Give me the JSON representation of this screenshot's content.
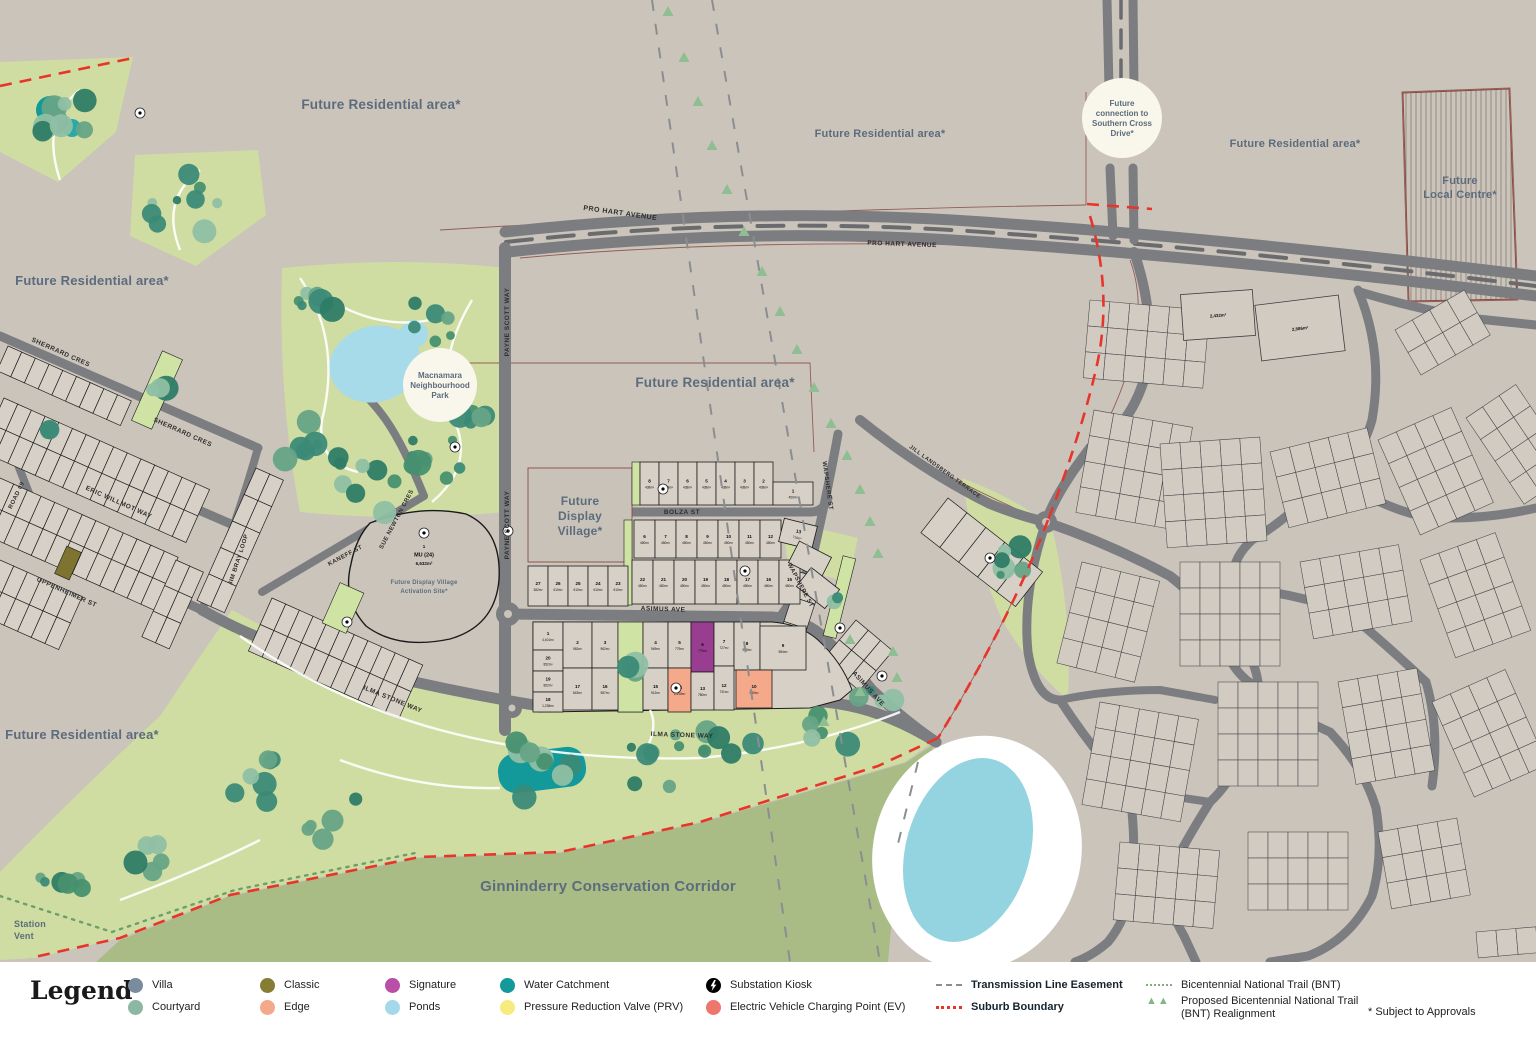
{
  "legend": {
    "title": "Legend",
    "items": [
      {
        "label": "Villa",
        "color": "#7b8b9e",
        "type": "dot"
      },
      {
        "label": "Courtyard",
        "color": "#8cb7a3",
        "type": "dot"
      },
      {
        "label": "Classic",
        "color": "#867d33",
        "type": "dot"
      },
      {
        "label": "Edge",
        "color": "#f4a98a",
        "type": "dot"
      },
      {
        "label": "Signature",
        "color": "#b94fa6",
        "type": "dot"
      },
      {
        "label": "Ponds",
        "color": "#a5d8e8",
        "type": "dot"
      },
      {
        "label": "Water Catchment",
        "color": "#14999b",
        "type": "dot"
      },
      {
        "label": "Pressure Reduction Valve (PRV)",
        "color": "#f7eb80",
        "type": "dot"
      },
      {
        "label": "Substation Kiosk",
        "color": "#000000",
        "type": "bolt"
      },
      {
        "label": "Electric Vehicle Charging Point (EV)",
        "color": "#ee766c",
        "type": "dot"
      },
      {
        "label": "Transmission Line Easement",
        "color": "#8b8e91",
        "type": "dash",
        "bold": true
      },
      {
        "label": "Suburb Boundary",
        "color": "#e8352b",
        "type": "reddash",
        "bold": true
      },
      {
        "label": "Bicentennial National Trail (BNT)",
        "color": "#7fae7f",
        "type": "dotted"
      },
      {
        "label": "Proposed Bicentennial National Trail (BNT) Realignment",
        "color": "#84b488",
        "type": "triangles"
      }
    ],
    "footnote": "* Subject to Approvals"
  },
  "map": {
    "colors": {
      "background": "#cbc4bb",
      "parkland": "#cfdda2",
      "conservation": "#a9bc85",
      "road": "#7c7d80",
      "lot_fill": "#d6d0c7",
      "suburb_lot_fill": "#d1cbc2",
      "pond": "#a7dbe9",
      "water_catchment": "#14999b",
      "signature_lot": "#993d90",
      "edge_lot": "#f4a98a",
      "classic_lot": "#7d7430",
      "boundary_red": "#e8352b",
      "easement_gray": "#8b8e91",
      "trail_green": "#6d9e6d"
    },
    "area_labels": [
      {
        "text": "Future Residential area*",
        "x": 381,
        "y": 109,
        "size": 13.5
      },
      {
        "text": "Future Residential area*",
        "x": 92,
        "y": 285,
        "size": 13
      },
      {
        "text": "Future Residential area*",
        "x": 880,
        "y": 137,
        "size": 11
      },
      {
        "text": "Future Residential area*",
        "x": 1295,
        "y": 147,
        "size": 11
      },
      {
        "text": "Future Residential area*",
        "x": 715,
        "y": 387,
        "size": 13.5
      },
      {
        "text": "Future Residential area*",
        "x": 82,
        "y": 739,
        "size": 13
      },
      {
        "text": "Ginninderry Conservation Corridor",
        "x": 608,
        "y": 891,
        "size": 15
      }
    ],
    "stacked_labels": [
      {
        "lines": [
          "Future",
          "Local Centre*"
        ],
        "x": 1460,
        "y": 184,
        "size": 11,
        "lh": 14
      },
      {
        "lines": [
          "Future",
          "Display",
          "Village*"
        ],
        "x": 580,
        "y": 505,
        "size": 12,
        "lh": 15
      },
      {
        "lines": [
          "Station",
          "Vent"
        ],
        "x": 14,
        "y": 927,
        "size": 9,
        "lh": 12,
        "color": "#3e6b51"
      }
    ],
    "callouts": [
      {
        "lines": [
          "Future",
          "connection to",
          "Southern Cross",
          "Drive*"
        ],
        "x": 1122,
        "y": 118,
        "r": 40,
        "size": 8
      },
      {
        "lines": [
          "Macnamara",
          "Neighbourhood",
          "Park"
        ],
        "x": 440,
        "y": 385,
        "r": 37,
        "size": 8
      }
    ],
    "mu_site": {
      "lines": [
        "1",
        "MU (24)",
        "6,632m²"
      ],
      "sub": [
        "Future Display Village",
        "Activation Site*"
      ]
    },
    "streets": [
      {
        "t": "PRO HART AVENUE",
        "x": 620,
        "y": 215,
        "r": 8,
        "s": 7
      },
      {
        "t": "PRO HART AVENUE",
        "x": 902,
        "y": 246,
        "r": 2,
        "s": 6.5
      },
      {
        "t": "PAYNE SCOTT WAY",
        "x": 509,
        "y": 322,
        "r": -90,
        "s": 6.5
      },
      {
        "t": "PAYNE SCOTT WAY",
        "x": 509,
        "y": 525,
        "r": -90,
        "s": 6.5
      },
      {
        "t": "SHERRARD CRES",
        "x": 60,
        "y": 354,
        "r": 24,
        "s": 6.5
      },
      {
        "t": "SHERRARD CRES",
        "x": 182,
        "y": 434,
        "r": 24,
        "s": 6.5
      },
      {
        "t": "ERIC WILLMOT WAY",
        "x": 118,
        "y": 504,
        "r": 24,
        "s": 6.5
      },
      {
        "t": "OPPENHEIMER ST",
        "x": 66,
        "y": 594,
        "r": 24,
        "s": 6.5
      },
      {
        "t": "ROAD 09",
        "x": 18,
        "y": 496,
        "r": -64,
        "s": 6
      },
      {
        "t": "JIM BRAY LOOP",
        "x": 240,
        "y": 560,
        "r": -72,
        "s": 6
      },
      {
        "t": "KANEFF ST",
        "x": 346,
        "y": 557,
        "r": -28,
        "s": 6
      },
      {
        "t": "SUE NEWTON CRES",
        "x": 398,
        "y": 520,
        "r": -62,
        "s": 6
      },
      {
        "t": "BOLZA ST",
        "x": 682,
        "y": 514,
        "r": 0,
        "s": 6.5
      },
      {
        "t": "WAPSHERE ST",
        "x": 826,
        "y": 486,
        "r": 82,
        "s": 6
      },
      {
        "t": "WAPSHERE ST",
        "x": 799,
        "y": 586,
        "r": 62,
        "s": 6
      },
      {
        "t": "ASIMUS AVE",
        "x": 663,
        "y": 611,
        "r": 2,
        "s": 6.5
      },
      {
        "t": "ASIMUS AVE",
        "x": 867,
        "y": 690,
        "r": 48,
        "s": 6.5
      },
      {
        "t": "ILMA STONE WAY",
        "x": 392,
        "y": 701,
        "r": 22,
        "s": 6.5
      },
      {
        "t": "ILMA STONE WAY",
        "x": 682,
        "y": 737,
        "r": 2,
        "s": 6.5
      },
      {
        "t": "JILL LANDSBERG TERRACE",
        "x": 944,
        "y": 473,
        "r": 36,
        "s": 5.5
      }
    ],
    "lots": {
      "asimus": [
        {
          "n": "1",
          "a": "4,401m²"
        },
        {
          "n": "2",
          "a": "962m²"
        },
        {
          "n": "3",
          "a": "962m²"
        },
        {
          "n": "4",
          "a": "949m²"
        },
        {
          "n": "5",
          "a": "779m²"
        },
        {
          "n": "6",
          "a": "779m²"
        },
        {
          "n": "7",
          "a": "727m²"
        },
        {
          "n": "8",
          "a": "908m²"
        },
        {
          "n": "9",
          "a": "984m²"
        },
        {
          "n": "10",
          "a": "930m²"
        },
        {
          "n": "12",
          "a": "731m²"
        },
        {
          "n": "13",
          "a": "780m²"
        },
        {
          "n": "14",
          "a": "1,440m²"
        },
        {
          "n": "15",
          "a": "912m²"
        },
        {
          "n": "16",
          "a": "987m²"
        },
        {
          "n": "17",
          "a": "843m²"
        },
        {
          "n": "18",
          "a": "1,238m²"
        },
        {
          "n": "19",
          "a": "852m²"
        },
        {
          "n": "20",
          "a": "852m²"
        }
      ],
      "bolza_north": [
        {
          "n": "8",
          "a": "438m²"
        },
        {
          "n": "7",
          "a": "438m²"
        },
        {
          "n": "6",
          "a": "438m²"
        },
        {
          "n": "5",
          "a": "438m²"
        },
        {
          "n": "4",
          "a": "438m²"
        },
        {
          "n": "3",
          "a": "438m²"
        },
        {
          "n": "2",
          "a": "438m²"
        },
        {
          "n": "1",
          "a": "450m²"
        }
      ],
      "bolza_south_top": [
        {
          "n": "6",
          "a": "450m²"
        },
        {
          "n": "7",
          "a": "450m²"
        },
        {
          "n": "8",
          "a": "450m²"
        },
        {
          "n": "9",
          "a": "450m²"
        },
        {
          "n": "10",
          "a": "450m²"
        },
        {
          "n": "11",
          "a": "450m²"
        },
        {
          "n": "12",
          "a": "450m²"
        },
        {
          "n": "13",
          "a": "716m²"
        }
      ],
      "bolza_south_bottom": [
        {
          "n": "22",
          "a": "450m²"
        },
        {
          "n": "21",
          "a": "450m²"
        },
        {
          "n": "20",
          "a": "450m²"
        },
        {
          "n": "19",
          "a": "450m²"
        },
        {
          "n": "18",
          "a": "450m²"
        },
        {
          "n": "17",
          "a": "450m²"
        },
        {
          "n": "16",
          "a": "450m²"
        },
        {
          "n": "15",
          "a": "450m²"
        }
      ],
      "payne_west": [
        {
          "n": "27",
          "a": "382m²"
        },
        {
          "n": "26",
          "a": "610m²"
        },
        {
          "n": "25",
          "a": "610m²"
        },
        {
          "n": "24",
          "a": "610m²"
        },
        {
          "n": "23",
          "a": "610m²"
        }
      ],
      "big_lots": [
        {
          "a": "2,432m²"
        },
        {
          "a": "2,586m²"
        }
      ]
    }
  }
}
